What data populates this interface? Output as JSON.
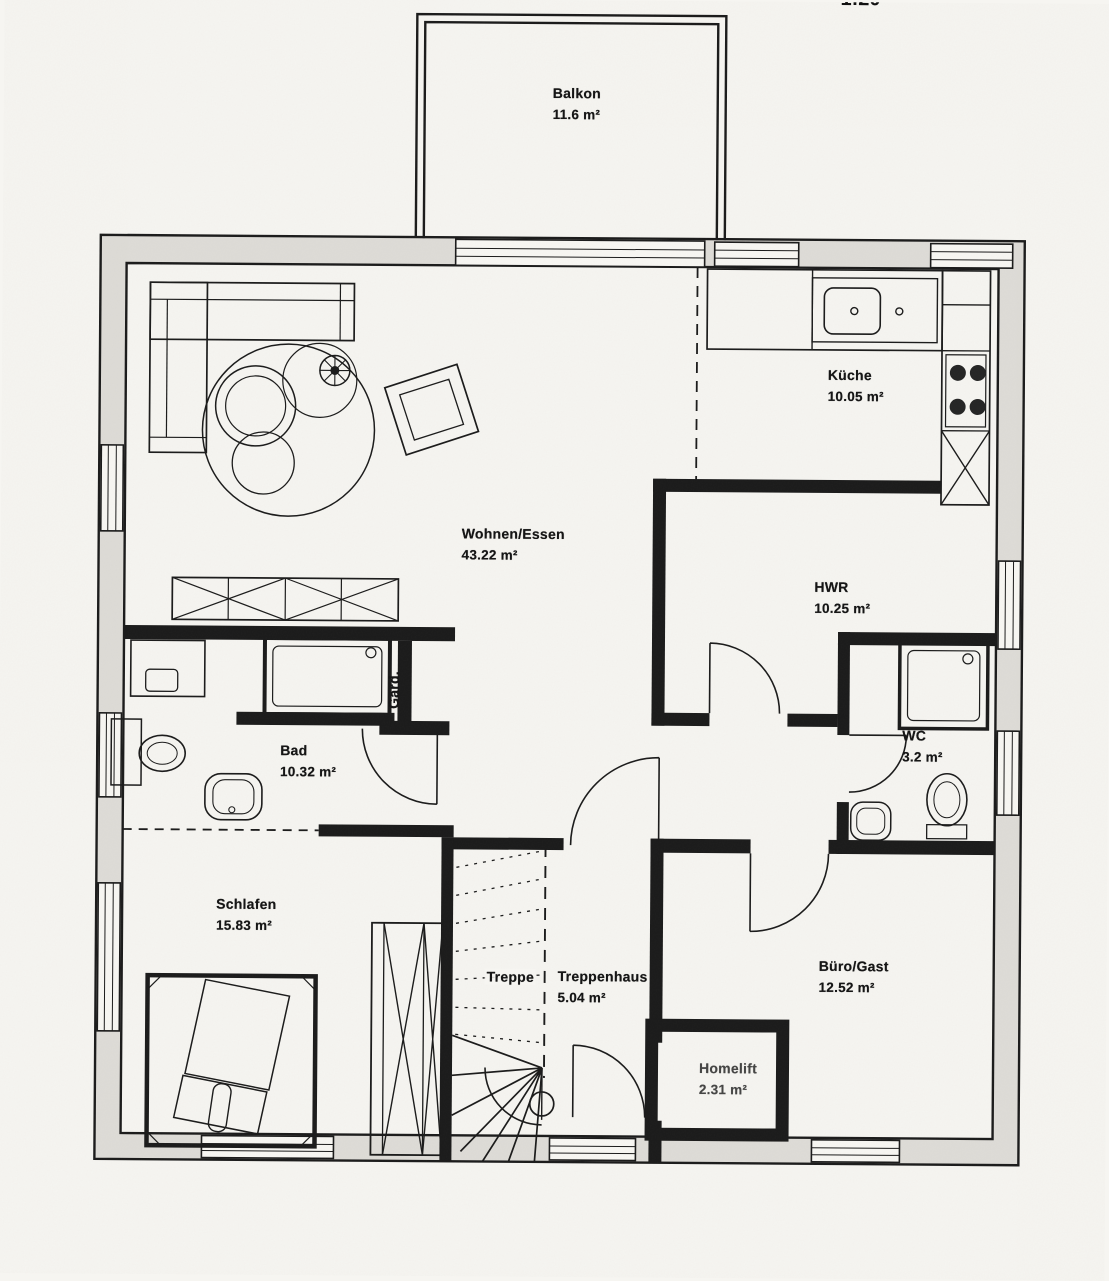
{
  "scale_note": "1:20",
  "rooms": {
    "balkon": {
      "name": "Balkon",
      "area": "11.6 m²"
    },
    "kueche": {
      "name": "Küche",
      "area": "10.05 m²"
    },
    "wohnen": {
      "name": "Wohnen/Essen",
      "area": "43.22 m²"
    },
    "hwr": {
      "name": "HWR",
      "area": "10.25 m²"
    },
    "bad": {
      "name": "Bad",
      "area": "10.32 m²"
    },
    "wc": {
      "name": "WC",
      "area": "3.2 m²"
    },
    "schlafen": {
      "name": "Schlafen",
      "area": "15.83 m²"
    },
    "treppe": {
      "name": "Treppe"
    },
    "treppenhaus": {
      "name": "Treppenhaus",
      "area": "5.04 m²"
    },
    "buero": {
      "name": "Büro/Gast",
      "area": "12.52 m²"
    },
    "homelift": {
      "name": "Homelift",
      "area": "2.31 m²"
    },
    "garderobe": {
      "name": "Gard."
    }
  },
  "colors": {
    "paper": "#f6f5f1",
    "ink": "#1a1a1a",
    "wall_fill": "#dedcd7"
  }
}
